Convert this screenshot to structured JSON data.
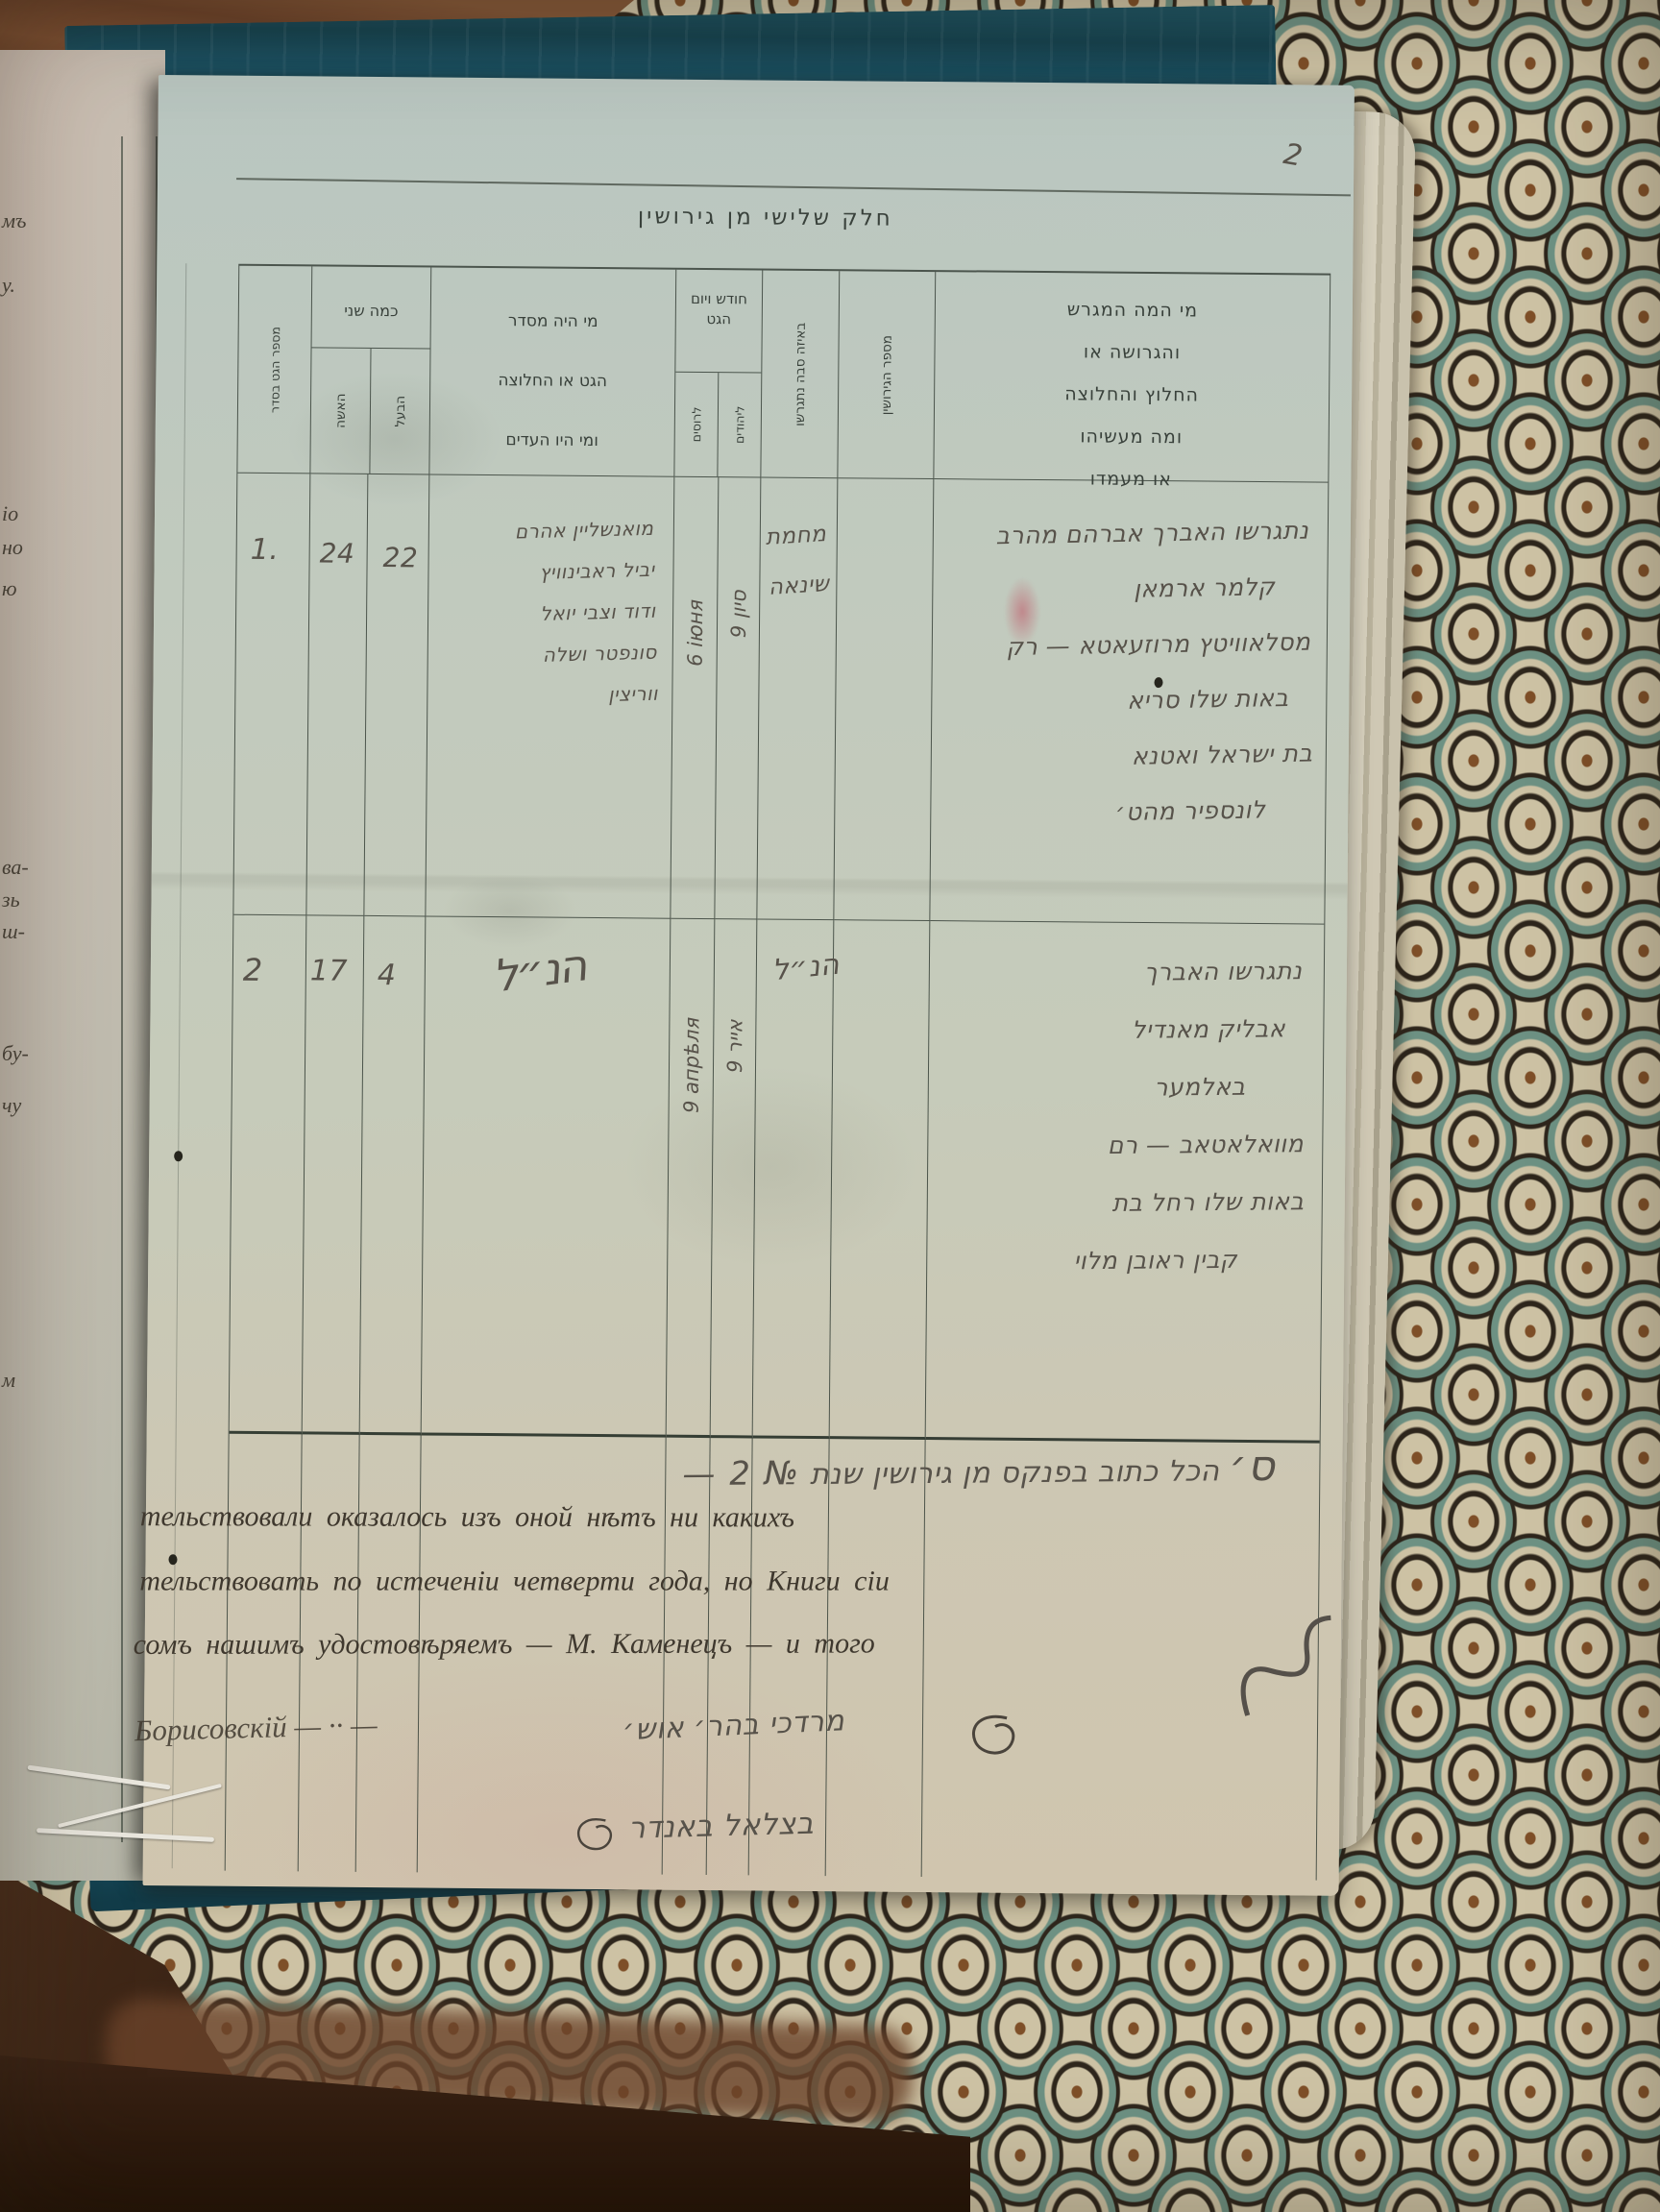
{
  "page_number": "2",
  "title": "חלק שלישי מן גירושין",
  "table": {
    "headers": {
      "no_vertical": "מספר הגט בסדר",
      "ages_label": "כמה שני",
      "ages_sub_wife": "האשה",
      "ages_sub_husband": "הבעל",
      "officiant_lines": [
        "מי היה מסדר",
        "הגט או החלוצה",
        "ומי היו העדים"
      ],
      "date_label_line1": "חודש ויום",
      "date_label_line2": "הגט",
      "date_sub_russian": "לרוסים",
      "date_sub_jewish": "ליהודים",
      "reason_vertical": "באיזה סבה נתגרשו",
      "count_vertical": "מספר הגירושין",
      "parties_lines": [
        "מי המה המגרש",
        "והגרושה או",
        "החלוץ והחלוצה",
        "ומה מעשיהו",
        "או מעמדו"
      ]
    },
    "rows": [
      {
        "no": "1.",
        "age_wife": "24",
        "age_husband": "22",
        "officiant_lines": [
          "מואנשליין אהרם",
          "יביל ראבינוויץ",
          "ודוד וצבי יואל",
          "סונפטר ושלה",
          "ווריצין"
        ],
        "date_russian": "6 іюня",
        "date_jewish": "9 סיון",
        "reason_lines": [
          "מחמת",
          "שינאה"
        ],
        "count": "",
        "parties_lines": [
          "נתגרשו האברך אברהם מהרב",
          "קלמר ארמאן",
          "מסלאוויטץ מרוזעאטא — רק",
          "באות שלו סריא",
          "בת ישראל ואטנא",
          "לונספיר מהט׳"
        ]
      },
      {
        "no": "2",
        "age_wife": "17",
        "age_husband": "4",
        "officiant_flourish": "הנ״ל",
        "date_russian": "9 апрѣля",
        "date_jewish": "9 אייר",
        "reason": "הנ״ל",
        "count": "",
        "parties_lines": [
          "נתגרשו האברך",
          "אבליק מאנדיל",
          "באלמער",
          "מוואלאטאב — רם",
          "באות שלו רחל בת",
          "קבין ראובן מלוי"
        ]
      }
    ]
  },
  "footer": {
    "hebrew_line_prefix": "ס׳",
    "hebrew_line": "הכל כתוב בפנקס מן גירושין שנת",
    "number_label": "№ 2 —",
    "russian_lines": [
      "тельствовали оказалось изъ оной нѣтъ ни какихъ",
      "тельствовать по истеченіи четверти года, но Книги сіи",
      "сомъ нашимъ удостовѣряемъ — М. Каменецъ — и того"
    ],
    "signature_russian": "Борисовскій — ·· —",
    "signature_hebrew_1": "מרדכי בהר׳ אוש׳",
    "signature_hebrew_2": "בצלאל באנדר"
  },
  "left_page_fragments": [
    {
      "text": "мъ"
    },
    {
      "text": "у."
    },
    {
      "text": "іо"
    },
    {
      "text": "но"
    },
    {
      "text": "ю"
    },
    {
      "text": "ва-"
    },
    {
      "text": "зь"
    },
    {
      "text": "ш-"
    },
    {
      "text": "бу-"
    },
    {
      "text": "чу"
    },
    {
      "text": "м"
    }
  ],
  "colors": {
    "paper": "#c6cbba",
    "ink": "#3f382e",
    "pencil": "#57524a",
    "cover": "#15424f",
    "wood": "#6e4730",
    "fabric_base": "#cdc2a4",
    "fabric_teal": "#6d9183"
  }
}
